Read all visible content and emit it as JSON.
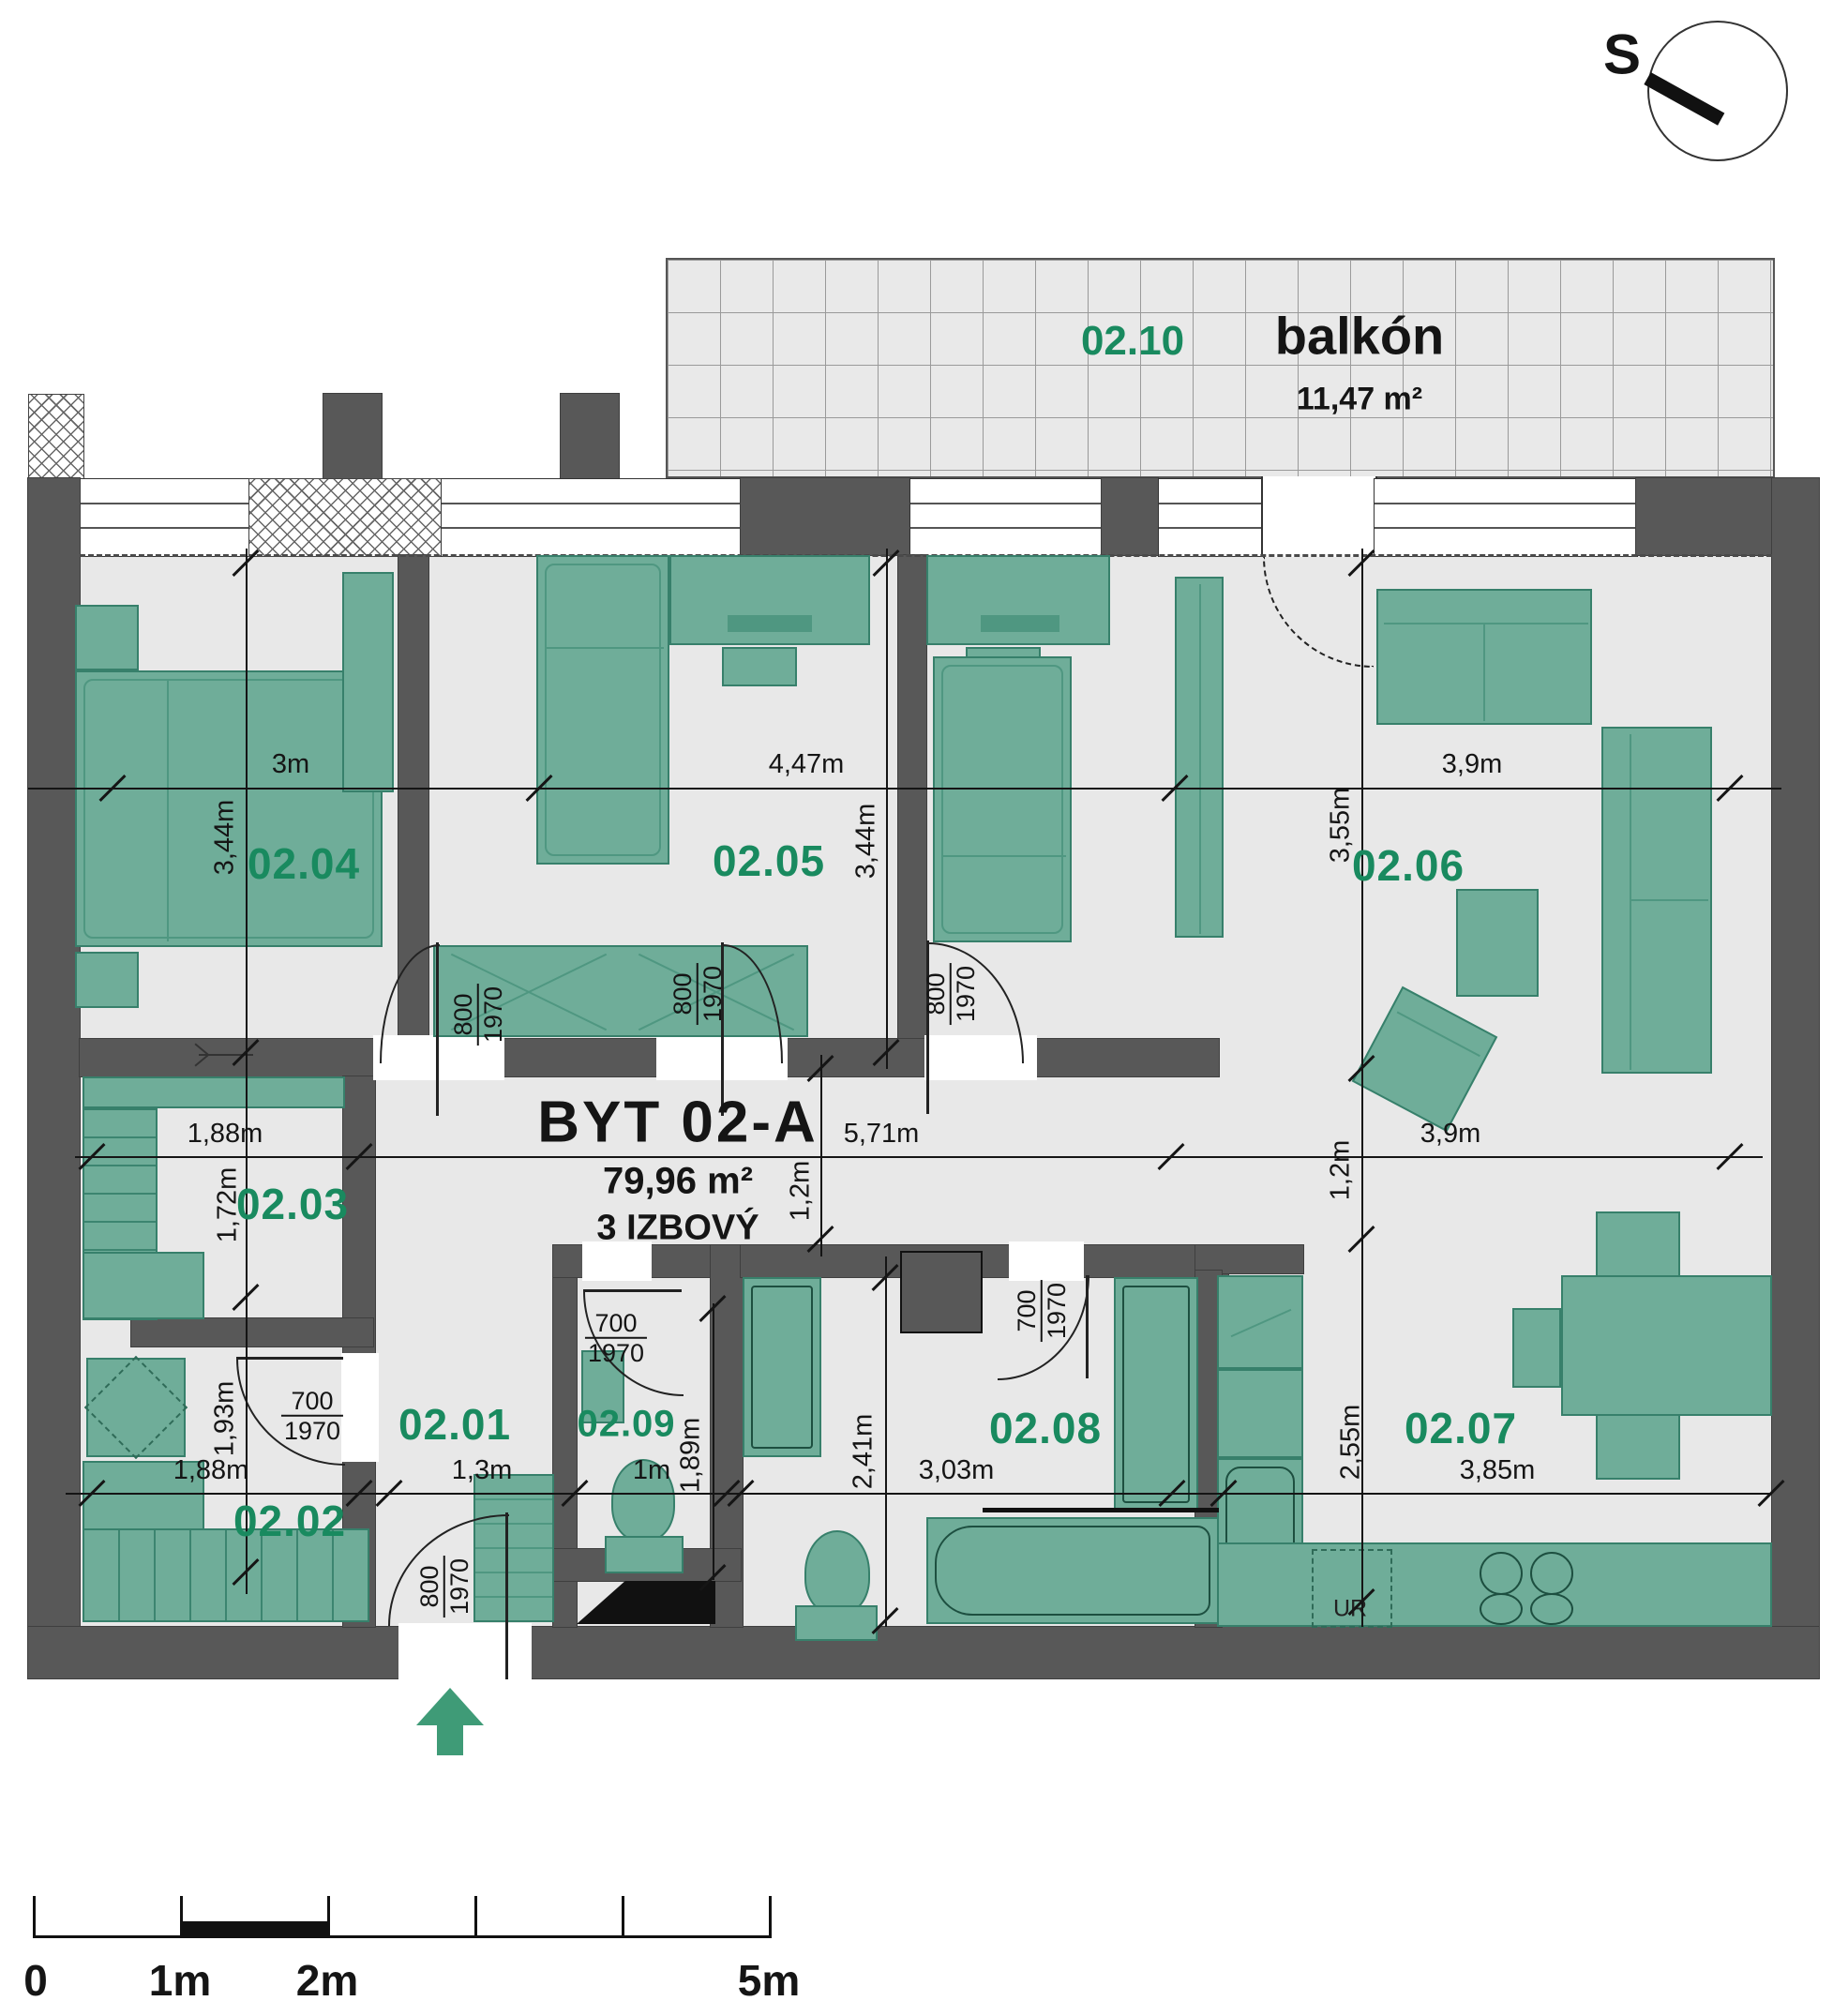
{
  "colors": {
    "accent_green": "#198a5f",
    "furniture_green": "#6fad99",
    "wall_gray": "#585858",
    "floor_gray": "#e8e8e8"
  },
  "compass": {
    "label": "S"
  },
  "balcony": {
    "number": "02.10",
    "name": "balkón",
    "area": "11,47 m²"
  },
  "apartment": {
    "name": "BYT 02-A",
    "area": "79,96 m²",
    "type": "3 IZBOVÝ"
  },
  "rooms": {
    "r0201": "02.01",
    "r0202": "02.02",
    "r0203": "02.03",
    "r0204": "02.04",
    "r0205": "02.05",
    "r0206": "02.06",
    "r0207": "02.07",
    "r0208": "02.08",
    "r0209": "02.09"
  },
  "dims": {
    "w0204": "3m",
    "w0205": "4,47m",
    "w0206": "3,9m",
    "h0204": "3,44m",
    "h0205": "3,44m",
    "h0206": "3,55m",
    "w0203": "1,88m",
    "hall_w": "5,71m",
    "w0207u": "3,9m",
    "h0203": "1,72m",
    "hall_h": "1,2m",
    "h0206b": "1,2m",
    "h0202": "1,93m",
    "w0202": "1,88m",
    "w0201": "1,3m",
    "w0209": "1m",
    "h0209": "1,89m",
    "h0208": "2,41m",
    "w0208": "3,03m",
    "h0207": "2,55m",
    "w0207": "3,85m"
  },
  "doors": {
    "width800": "800",
    "width700": "700",
    "height1970": "1970"
  },
  "kitchen": {
    "ur": "UR"
  },
  "scale_bar": {
    "t0": "0",
    "t1": "1m",
    "t2": "2m",
    "t5": "5m"
  }
}
